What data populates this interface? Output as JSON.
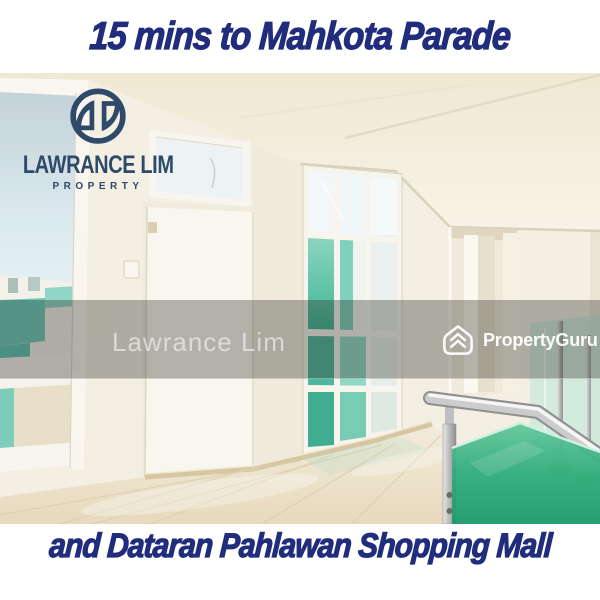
{
  "top_banner": {
    "text": "15 mins to Mahkota Parade"
  },
  "bottom_banner": {
    "text": "and Dataran Pahlawan Shopping Mall"
  },
  "agency_logo": {
    "title": "LAWRANCE LIM",
    "subtitle": "PROPERTY",
    "icon": "lawrance-lim-monogram-icon"
  },
  "watermarks": {
    "agent": {
      "text": "Lawrance Lim"
    },
    "brand": {
      "text": "PropertyGuru",
      "icon": "propertyguru-logo-icon"
    }
  },
  "colors": {
    "banner_text": "#212c7c",
    "logo_navy": "#2e4a68",
    "watermark_white": "rgba(255,255,255,0.55)",
    "overlay_band": "rgba(42,40,34,0.34)",
    "glass_green": "#1d9e6e",
    "rail_silver": "#c9c9c9",
    "floor_beige": "#ecdfc6",
    "wall_ivory": "#f3efe3"
  }
}
